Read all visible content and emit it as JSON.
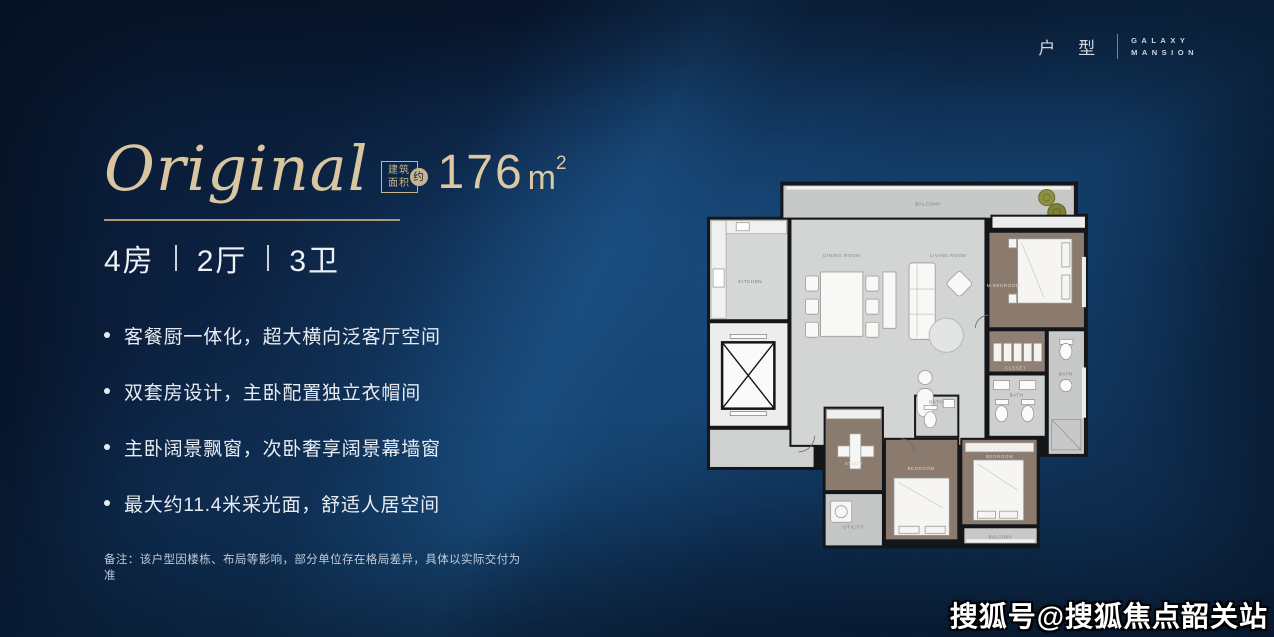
{
  "colors": {
    "background_dark": "#0a1c36",
    "background_light": "#1c5892",
    "accent_gold": "#d9c6a1",
    "text_light": "#e8ecf2",
    "plan_floor": "#d3d5d4",
    "plan_wood": "#8a7b6e",
    "plan_wall": "#15161a",
    "plant_green": "#8f9140"
  },
  "brand": {
    "category": "户 型",
    "name_top": "GALAXY",
    "name_bottom": "MANSION"
  },
  "title": {
    "name": "Original",
    "tag_top": "建筑",
    "tag_bottom": "面积",
    "tag_circle": "约",
    "area_value": "176",
    "area_unit": "m",
    "area_sup": "2"
  },
  "unit": {
    "beds": "4房",
    "halls": "2厅",
    "baths": "3卫"
  },
  "features": [
    {
      "text": "客餐厨一体化，超大横向泛客厅空间"
    },
    {
      "text": "双套房设计，主卧配置独立衣帽间"
    },
    {
      "text": "主卧阔景飘窗，次卧奢享阔景幕墙窗"
    },
    {
      "text": "最大约11.4米采光面，舒适人居空间"
    }
  ],
  "note": "备注：该户型因楼栋、布局等影响，部分单位存在格局差异，具体以实际交付为准",
  "watermark": "搜狐号@搜狐焦点韶关站",
  "floorplan": {
    "labels": {
      "balcony": "BALCONY",
      "kitchen": "KITCHEN",
      "dining": "DINING ROOM",
      "living": "LIVING ROOM",
      "master": "M.BEDROOM",
      "closet": "CLOSET",
      "bath_a": "BATH",
      "bath_b": "BATH",
      "bath_c": "BATH",
      "study": "STUDY",
      "bedroom_b": "BEDROOM",
      "bedroom_c": "BEDROOM",
      "utility": "UTILITY",
      "balcony_b": "BALCONY"
    }
  }
}
